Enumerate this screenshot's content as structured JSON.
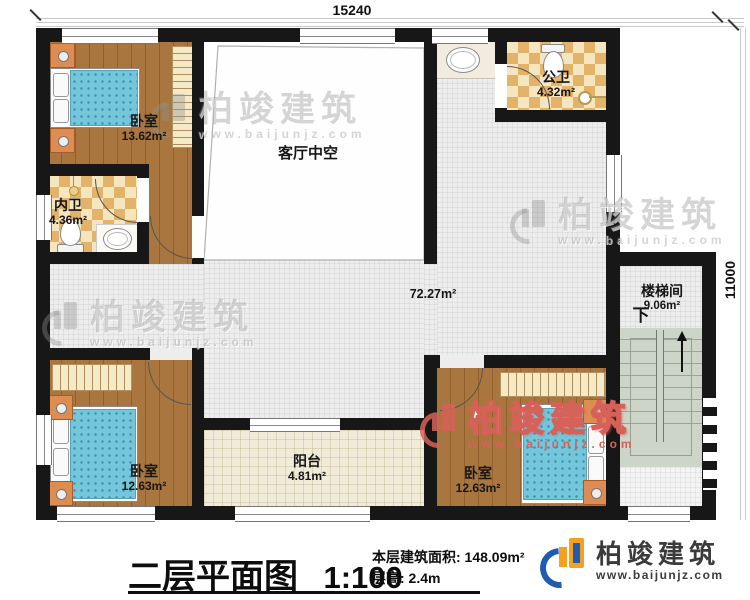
{
  "dimensions": {
    "top": "15240",
    "right": "11000"
  },
  "rooms": {
    "bedroom_tl": {
      "name": "卧室",
      "area": "13.62m²"
    },
    "inner_bath": {
      "name": "内卫",
      "area": "4.36m²"
    },
    "living_void": {
      "name": "客厅中空"
    },
    "public_bath": {
      "name": "公卫",
      "area": "4.32m²"
    },
    "hallway": {
      "area": "72.27m²"
    },
    "stairwell": {
      "name": "楼梯间",
      "area": "9.06m²",
      "direction": "下"
    },
    "bedroom_bl": {
      "name": "卧室",
      "area": "12.63m²"
    },
    "balcony": {
      "name": "阳台",
      "area": "4.81m²"
    },
    "bedroom_br": {
      "name": "卧室",
      "area": "12.63m²"
    }
  },
  "title_block": {
    "title": "二层平面图",
    "scale": "1:100",
    "area_line": "本层建筑面积: 148.09m²",
    "height_line": "层高: 2.4m"
  },
  "brand": {
    "name": "柏竣建筑",
    "url": "www.baijunjz.com"
  },
  "colors": {
    "wall": "#171717",
    "wood": "#a8763e",
    "tile": "#ededed",
    "stair": "#cdd4c8",
    "logo_blue": "#1f5cb0",
    "logo_orange": "#f5a01e"
  }
}
